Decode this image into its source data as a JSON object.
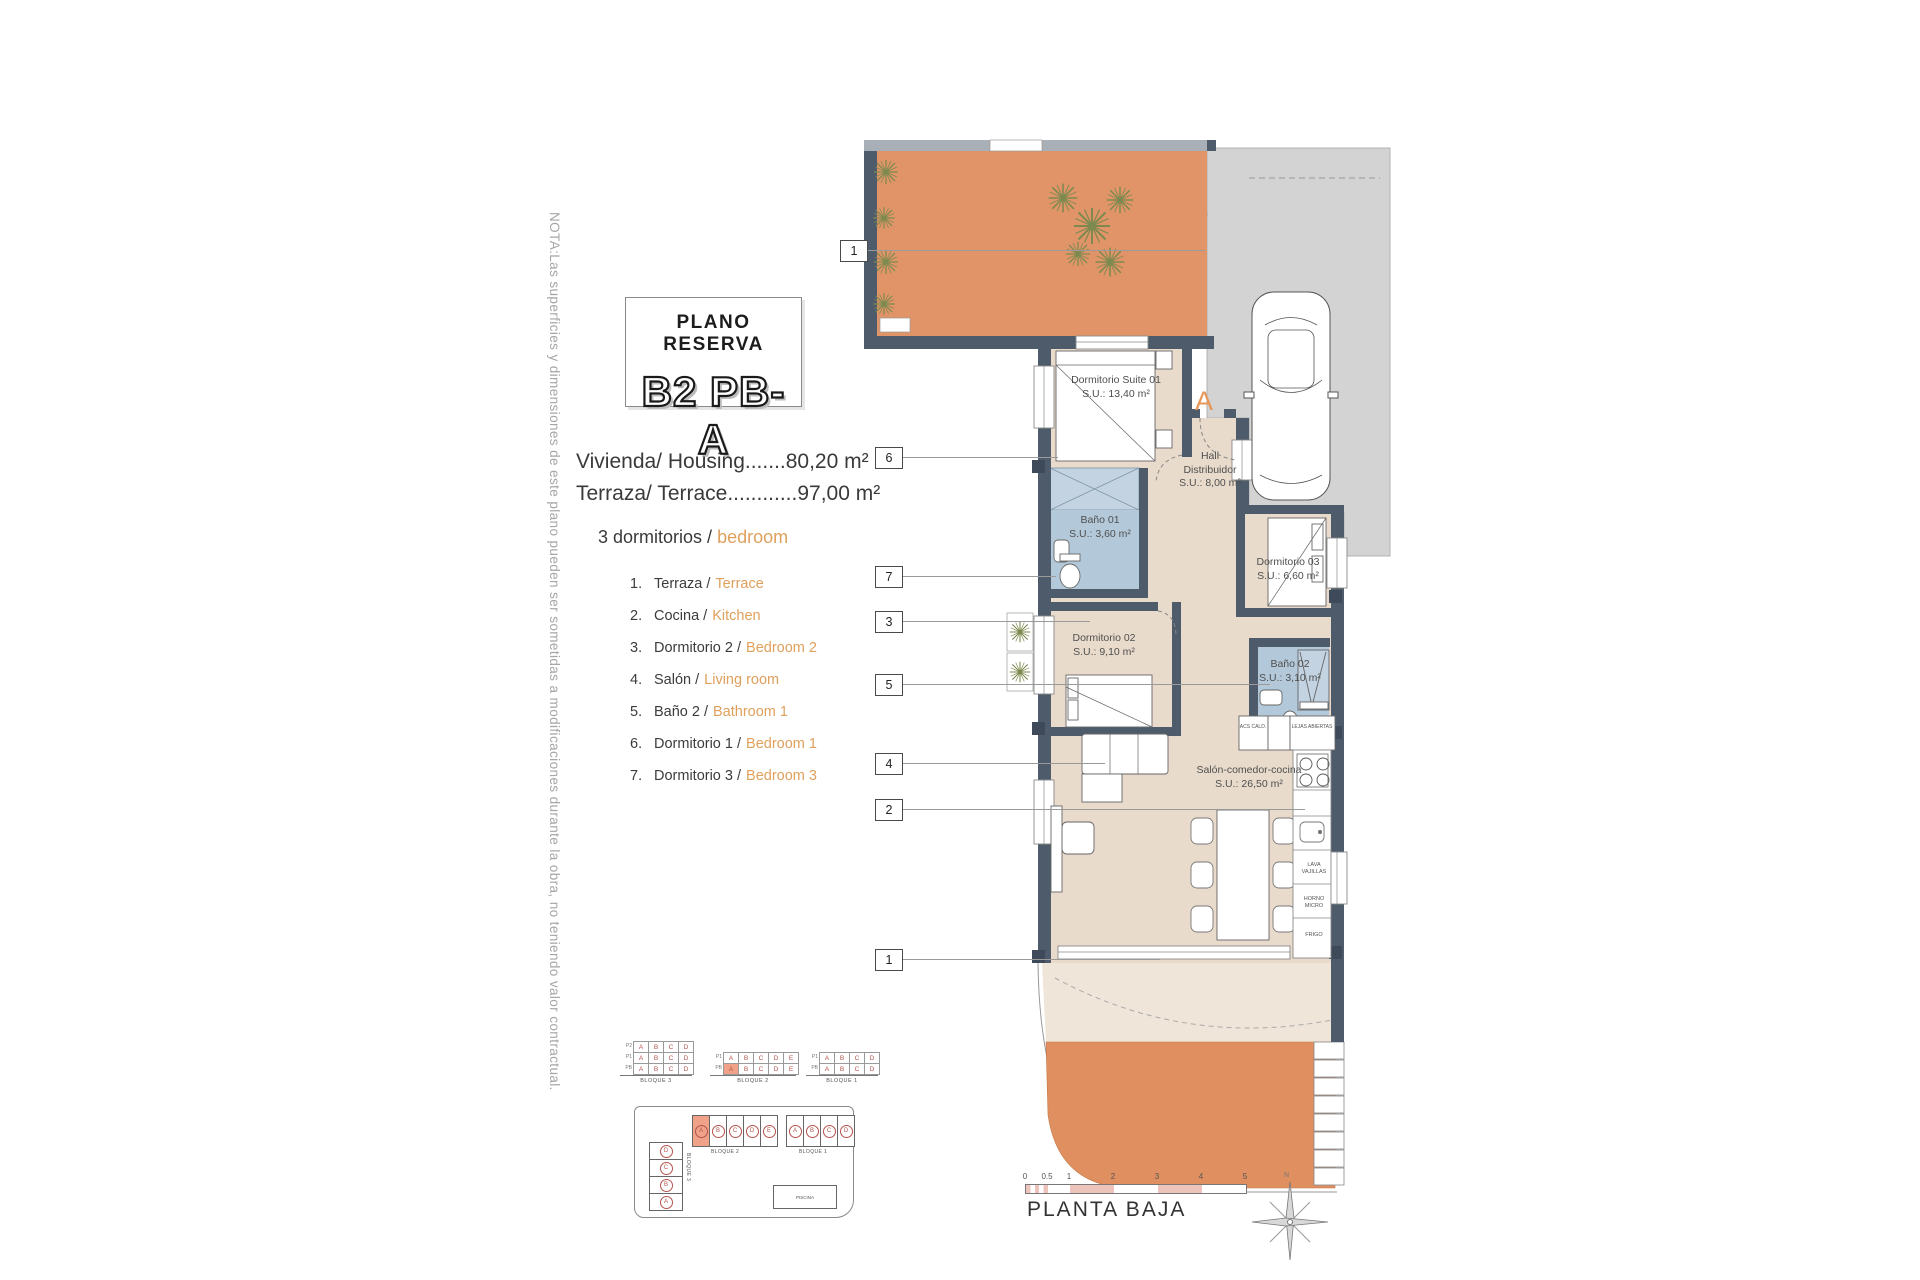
{
  "note": "NOTA:Las superficies y dimensiones de este plano pueden ser sometidas a modificaciones durante la obra, no teniendo valor contractual.",
  "header": {
    "title": "PLANO RESERVA",
    "code": "B2 PB-A"
  },
  "areas": {
    "housing": "Vivienda/ Housing.......80,20 m²",
    "terrace": "Terraza/ Terrace............97,00 m²"
  },
  "bedrooms": {
    "es": "3 dormitorios /",
    "en": "bedroom"
  },
  "legend": {
    "items": [
      {
        "num": "1.",
        "es": "Terraza /",
        "en": "Terrace"
      },
      {
        "num": "2.",
        "es": "Cocina /",
        "en": "Kitchen"
      },
      {
        "num": "3.",
        "es": "Dormitorio 2 /",
        "en": "Bedroom 2"
      },
      {
        "num": "4.",
        "es": "Salón /",
        "en": "Living room"
      },
      {
        "num": "5.",
        "es": "Baño 2 /",
        "en": "Bathroom 1"
      },
      {
        "num": "6.",
        "es": "Dormitorio 1 /",
        "en": "Bedroom 1"
      },
      {
        "num": "7.",
        "es": "Dormitorio 3 /",
        "en": "Bedroom 3"
      }
    ]
  },
  "plan": {
    "entry_label": "A",
    "markers": [
      "1",
      "6",
      "7",
      "3",
      "5",
      "4",
      "2",
      "1"
    ],
    "rooms": {
      "suite": {
        "name": "Dormitorio Suite 01",
        "area": "S.U.: 13,40 m²"
      },
      "hall": {
        "name": "Hall Distribuidor",
        "area": "S.U.: 8,00 m²"
      },
      "bano1": {
        "name": "Baño 01",
        "area": "S.U.: 3,60 m²"
      },
      "dorm3": {
        "name": "Dormitorio 03",
        "area": "S.U.: 6,60 m²"
      },
      "dorm2": {
        "name": "Dormitorio 02",
        "area": "S.U.: 9,10 m²"
      },
      "bano2": {
        "name": "Baño 02",
        "area": "S.U.: 3,10 m²"
      },
      "salon": {
        "name": "Salón-comedor-cocina",
        "area": "S.U.: 26,50 m²"
      }
    },
    "kitchen": {
      "appliances": [
        "LAVA VAJILLAS",
        "HORNO MICRO",
        "FRIGO"
      ],
      "cabinets": [
        "ACS CALD.",
        "LEJAS ABIERTAS"
      ]
    }
  },
  "blocks": {
    "b3": {
      "label": "BLOQUE 3",
      "rows": [
        {
          "label": "P2",
          "cells": [
            {
              "t": "A"
            },
            {
              "t": "B"
            },
            {
              "t": "C"
            },
            {
              "t": "D"
            }
          ]
        },
        {
          "label": "P1",
          "cells": [
            {
              "t": "A"
            },
            {
              "t": "B"
            },
            {
              "t": "C"
            },
            {
              "t": "D"
            }
          ]
        },
        {
          "label": "PB",
          "cells": [
            {
              "t": "A"
            },
            {
              "t": "B"
            },
            {
              "t": "C"
            },
            {
              "t": "D"
            }
          ]
        }
      ]
    },
    "b2": {
      "label": "BLOQUE 2",
      "rows": [
        {
          "label": "P1",
          "cells": [
            {
              "t": "A"
            },
            {
              "t": "B"
            },
            {
              "t": "C"
            },
            {
              "t": "D"
            },
            {
              "t": "E"
            }
          ]
        },
        {
          "label": "PB",
          "cells": [
            {
              "t": "A",
              "hl": true
            },
            {
              "t": "B"
            },
            {
              "t": "C"
            },
            {
              "t": "D"
            },
            {
              "t": "E"
            }
          ]
        }
      ]
    },
    "b1": {
      "label": "BLOQUE 1",
      "rows": [
        {
          "label": "P1",
          "cells": [
            {
              "t": "A"
            },
            {
              "t": "B"
            },
            {
              "t": "C"
            },
            {
              "t": "D"
            }
          ]
        },
        {
          "label": "PB",
          "cells": [
            {
              "t": "A"
            },
            {
              "t": "B"
            },
            {
              "t": "C"
            },
            {
              "t": "D"
            }
          ]
        }
      ]
    }
  },
  "keyplan": {
    "b2": {
      "label": "BLOQUE 2",
      "units": [
        {
          "t": "A",
          "hl": true
        },
        {
          "t": "B"
        },
        {
          "t": "C"
        },
        {
          "t": "D"
        },
        {
          "t": "E"
        }
      ]
    },
    "b1": {
      "label": "BLOQUE 1",
      "units": [
        {
          "t": "A"
        },
        {
          "t": "B"
        },
        {
          "t": "C"
        },
        {
          "t": "D"
        }
      ]
    },
    "b3": {
      "label": "BLOQUE 3",
      "units": [
        {
          "t": "D"
        },
        {
          "t": "C"
        },
        {
          "t": "B"
        },
        {
          "t": "A"
        }
      ]
    },
    "pool": "PISCINA"
  },
  "footer": {
    "title": "PLANTA BAJA",
    "compass": "N",
    "scale_labels": [
      "0",
      "0.5",
      "1",
      "2",
      "3",
      "4",
      "5"
    ]
  },
  "colors": {
    "accent": "#dfa05c",
    "terrace": "#e09468",
    "bathroom": "#b3c9da",
    "wall": "#4e5b6b",
    "highlight": "#efa287",
    "paving": "#d3d3d3"
  }
}
